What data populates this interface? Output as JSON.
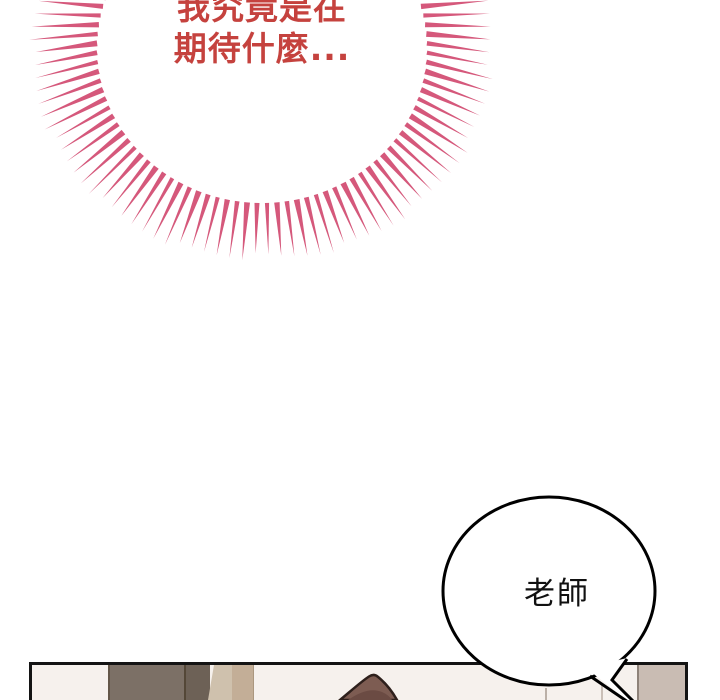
{
  "burst": {
    "line1": "我究竟是在",
    "line2": "期待什麼...",
    "text_color": "#c5423e",
    "spike_color": "#d5587b",
    "center_x": 262,
    "center_y": 48,
    "virtual_y": 20,
    "inner_rx": 165,
    "inner_ry": 155,
    "spike_count": 104,
    "base_len": 50,
    "side_extra": 12,
    "jitter": 8,
    "base_width": 4.2
  },
  "bubble": {
    "text": "老師",
    "fill": "#ffffff",
    "stroke": "#000000"
  },
  "panel": {
    "border_color": "#141414",
    "wall_color": "#f6f1ed",
    "cabinet_color": "#7c7066",
    "trim_colors": [
      "#cfc1ad",
      "#c3ae97"
    ],
    "door_color": "#c9bcb3",
    "hair_color": "#7d5c52"
  }
}
